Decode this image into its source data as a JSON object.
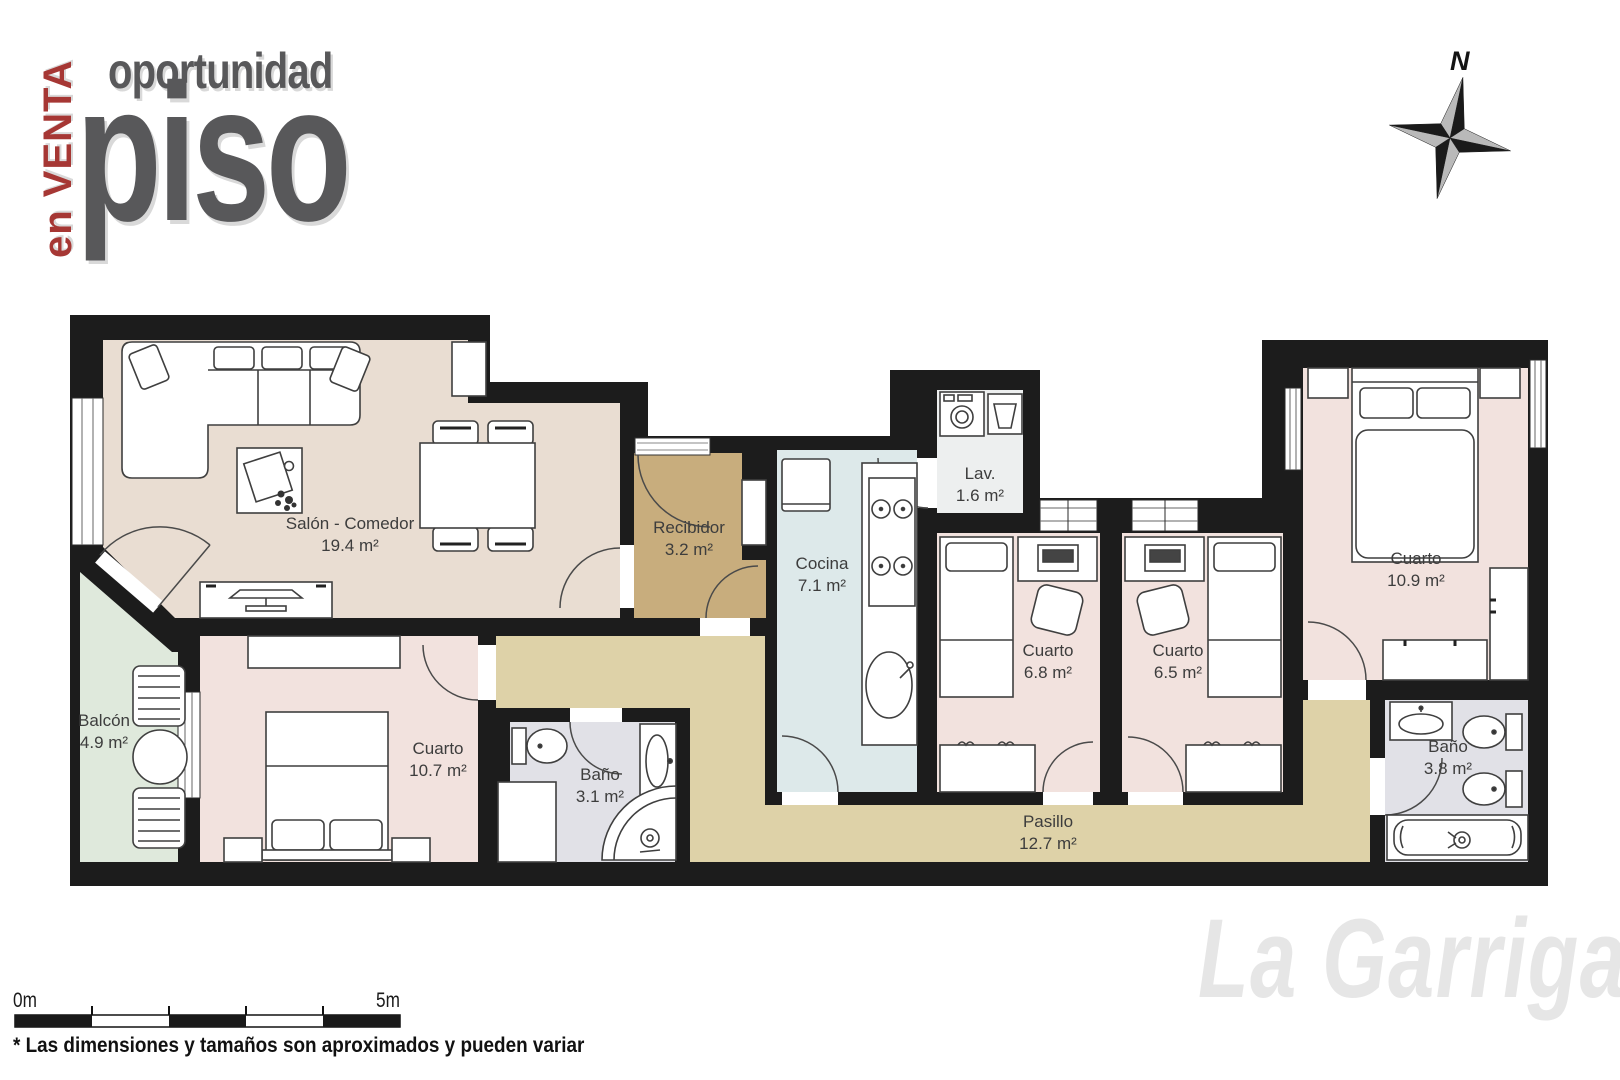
{
  "title": {
    "vertical": "en VENTA",
    "line1": "oportunidad",
    "line2": "piso"
  },
  "compass": {
    "north_label": "N"
  },
  "rooms": [
    {
      "id": "salon",
      "name": "Salón - Comedor",
      "area": "19.4 m²"
    },
    {
      "id": "recibidor",
      "name": "Recibidor",
      "area": "3.2 m²"
    },
    {
      "id": "cocina",
      "name": "Cocina",
      "area": "7.1 m²"
    },
    {
      "id": "lavadero",
      "name": "Lav.",
      "area": "1.6 m²"
    },
    {
      "id": "cuarto-68",
      "name": "Cuarto",
      "area": "6.8 m²"
    },
    {
      "id": "cuarto-65",
      "name": "Cuarto",
      "area": "6.5 m²"
    },
    {
      "id": "cuarto-109",
      "name": "Cuarto",
      "area": "10.9 m²"
    },
    {
      "id": "bano-38",
      "name": "Baño",
      "area": "3.8 m²"
    },
    {
      "id": "pasillo",
      "name": "Pasillo",
      "area": "12.7 m²"
    },
    {
      "id": "bano-31",
      "name": "Baño",
      "area": "3.1 m²"
    },
    {
      "id": "cuarto-107",
      "name": "Cuarto",
      "area": "10.7 m²"
    },
    {
      "id": "balcon",
      "name": "Balcón",
      "area": "4.9 m²"
    }
  ],
  "scale_bar": {
    "start_label": "0m",
    "end_label": "5m"
  },
  "disclaimer": "* Las dimensiones y tamaños son aproximados y pueden variar",
  "watermark": "La Garriga",
  "colors": {
    "wall": "#1c1c1c",
    "salon_floor": "#e9ddd2",
    "bedroom_floor": "#f2e2de",
    "recibidor_floor": "#c8ad7d",
    "pasillo_floor": "#ded2a8",
    "cocina_floor": "#dde9ea",
    "bath_floor": "#e1e1e7",
    "lav_floor": "#edefef",
    "balcon_floor": "#dfe9dc",
    "accent_red": "#a63734",
    "title_gray": "#58585a",
    "watermark_gray": "#e6e6e6"
  }
}
